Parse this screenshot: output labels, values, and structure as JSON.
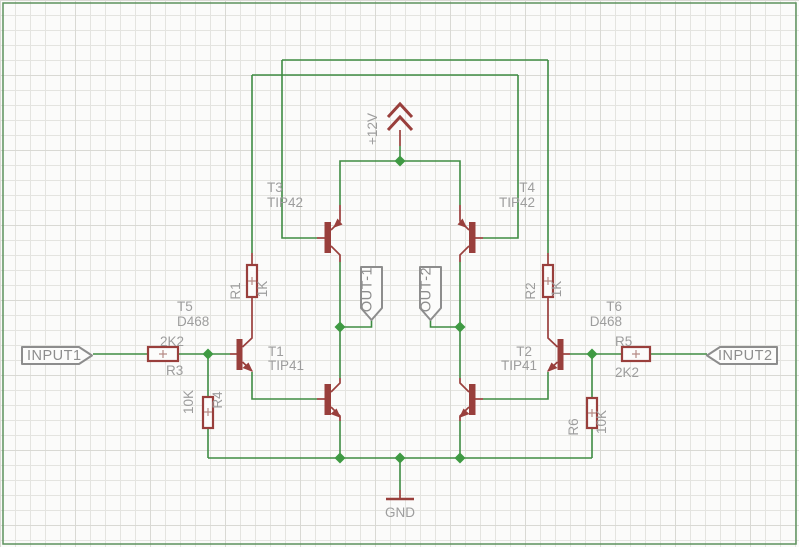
{
  "schematic": {
    "nets": {
      "vcc": "+12V",
      "gnd": "GND",
      "input1": "INPUT1",
      "input2": "INPUT2",
      "out1": "OUT-1",
      "out2": "OUT-2"
    },
    "parts": {
      "t1": {
        "name": "T1",
        "value": "TIP41"
      },
      "t2": {
        "name": "T2",
        "value": "TIP41"
      },
      "t3": {
        "name": "T3",
        "value": "TIP42"
      },
      "t4": {
        "name": "T4",
        "value": "TIP42"
      },
      "t5": {
        "name": "T5",
        "value": "D468"
      },
      "t6": {
        "name": "T6",
        "value": "D468"
      },
      "r1": {
        "name": "R1",
        "value": "1K"
      },
      "r2": {
        "name": "R2",
        "value": "1K"
      },
      "r3": {
        "name": "R3",
        "value": "2K2"
      },
      "r4": {
        "name": "R4",
        "value": "10K"
      },
      "r5": {
        "name": "R5",
        "value": "2K2"
      },
      "r6": {
        "name": "R6",
        "value": "10K"
      }
    },
    "colors": {
      "wire": "#3f8c43",
      "symbol": "#993f3c",
      "label": "#9d9d9d",
      "port_outline": "#8d8d8d",
      "frame": "#5d925d",
      "grid": "#e4e4e0"
    }
  }
}
